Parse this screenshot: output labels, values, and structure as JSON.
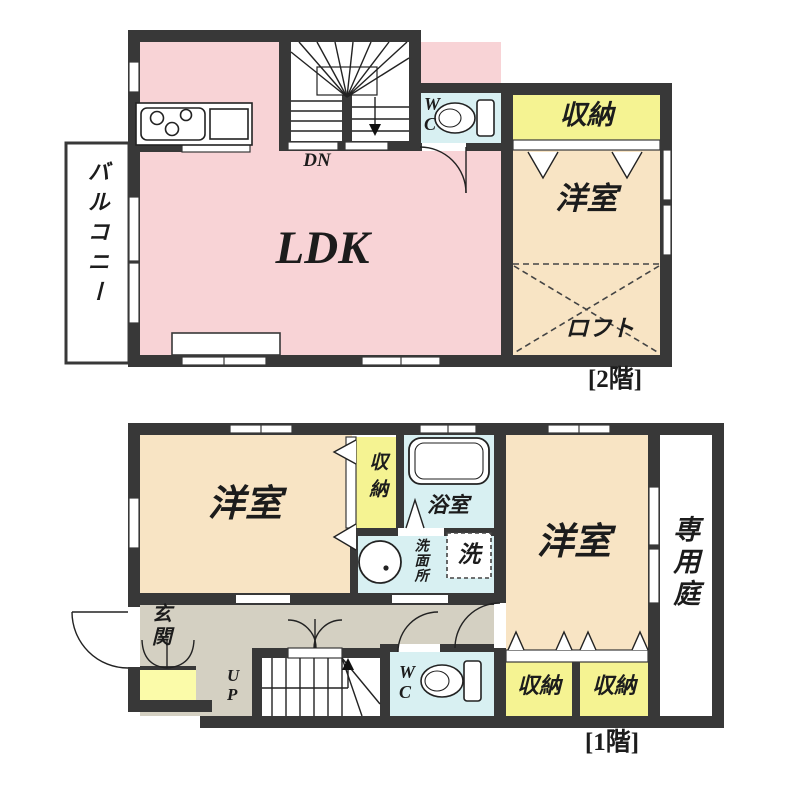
{
  "colors": {
    "wall": "#383838",
    "ldk_pink": "#f8d3d6",
    "room_beige": "#f8e4c4",
    "closet_yellow": "#f5f392",
    "water_blue": "#d8f0f2",
    "hall_gray": "#d4d0c2",
    "entry_closet_yellow": "#fbfba9"
  },
  "floor2": {
    "caption": "[2階]",
    "ldk": "LDK",
    "stairs_direction": "DN",
    "toilet": "W\nC",
    "closet": "収納",
    "bedroom": "洋室",
    "loft": "ロフト",
    "balcony": "バルコニー"
  },
  "floor1": {
    "caption": "[1階]",
    "bedroom_left": "洋室",
    "bedroom_right": "洋室",
    "closet_side": "収納",
    "bathroom": "浴室",
    "washroom": "洗面所",
    "washer": "洗",
    "garden": "専用庭",
    "entrance": "玄関",
    "stairs_direction": "U\nP",
    "toilet": "W\nC",
    "closet_a": "収納",
    "closet_b": "収納"
  }
}
